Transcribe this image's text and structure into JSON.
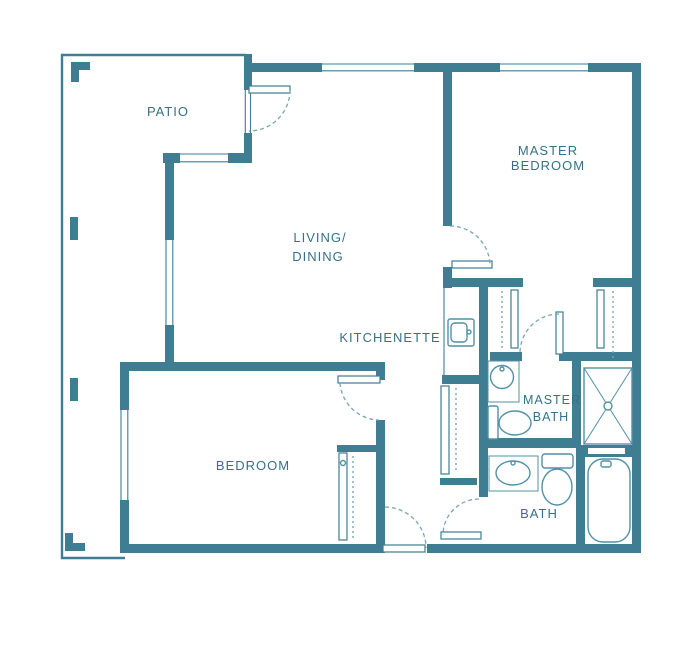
{
  "colors": {
    "wall": "#3E7D92",
    "fixture": "#5191A6",
    "label": "#357189",
    "dash": "#7AA5B5"
  },
  "rooms": {
    "patio": {
      "label": "PATIO"
    },
    "living_dining": {
      "label_line1": "LIVING/",
      "label_line2": "DINING"
    },
    "master_bedroom": {
      "label_line1": "MASTER",
      "label_line2": "BEDROOM"
    },
    "kitchenette": {
      "label": "KITCHENETTE"
    },
    "master_bath": {
      "label_line1": "MASTER",
      "label_line2": "BATH"
    },
    "bedroom": {
      "label": "BEDROOM"
    },
    "bath": {
      "label": "BATH"
    }
  }
}
